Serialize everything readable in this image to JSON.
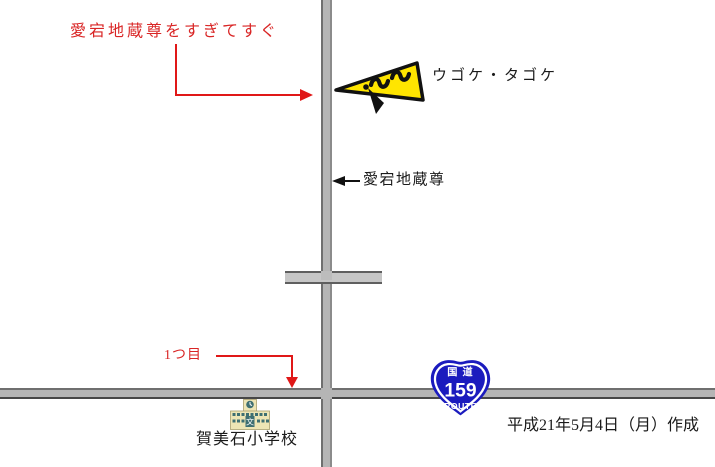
{
  "annotations": {
    "top_note": {
      "text": "愛宕地蔵尊をすぎてすぐ",
      "color": "#d92525"
    },
    "glider_label": {
      "text": "ウゴケ・タゴケ"
    },
    "jizoson_label": {
      "text": "愛宕地蔵尊"
    },
    "first_turn": {
      "text": "1つ目",
      "color": "#d92525"
    },
    "school_label": {
      "text": "賀美石小学校"
    },
    "date_note": {
      "text": "平成21年5月4日（月）作成"
    }
  },
  "route_shield": {
    "top_label": "国道",
    "number": "159",
    "bottom_label": "ROUTE",
    "color": "#1b1bbe"
  },
  "school_icon": {
    "symbol": "文"
  },
  "colors": {
    "annotation_red": "#e01818",
    "road_fill": "#b5b5b5",
    "road_edge": "#6f6f6f",
    "glider_yellow": "#ffe500",
    "shield_blue": "#1b1bbe",
    "school_teal": "#3e6f72",
    "school_cream": "#ede5b5",
    "background": "#ffffff"
  }
}
